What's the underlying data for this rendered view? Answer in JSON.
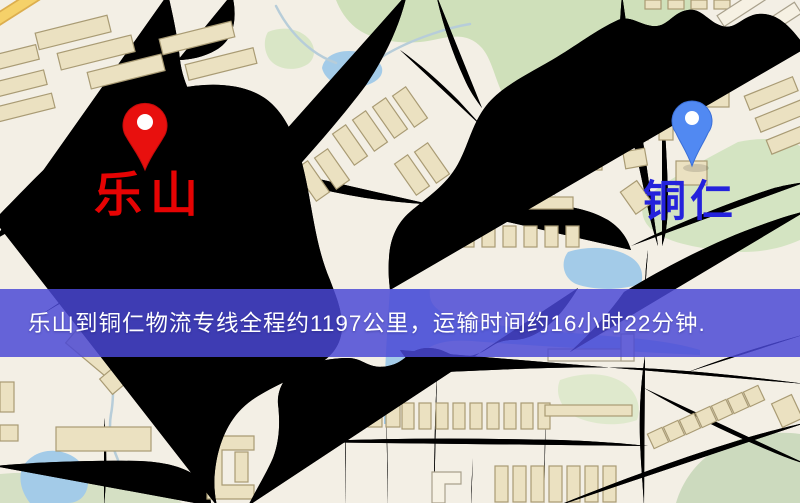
{
  "banner": {
    "text": "乐山到铜仁物流专线全程约1197公里，运输时间约16小时22分钟.",
    "background_color": "#4a47d5",
    "text_color": "#ffffff"
  },
  "route": {
    "origin": "乐山",
    "destination": "铜仁",
    "service": "物流专线",
    "distance": "约1197公里",
    "duration": "约16小时22分钟"
  },
  "map": {
    "origin_marker": {
      "label": "乐山",
      "pin_color": "#e8100e",
      "pin_stroke": "#c50b0b",
      "label_color": "#e60303"
    },
    "destination_marker": {
      "label": "铜仁",
      "pin_color": "#5189f2",
      "pin_stroke": "#3a6fd8",
      "label_color": "#2422dc"
    }
  },
  "palette": {
    "map_background": "#f3efe5",
    "road_fill": "#f5d169",
    "road_casing": "#dcae4e",
    "park_green": "#cfe0ba",
    "water_blue": "#a3cbe8",
    "railway_dark": "#2b2b2b",
    "building_tan": "#ebe1c1"
  }
}
